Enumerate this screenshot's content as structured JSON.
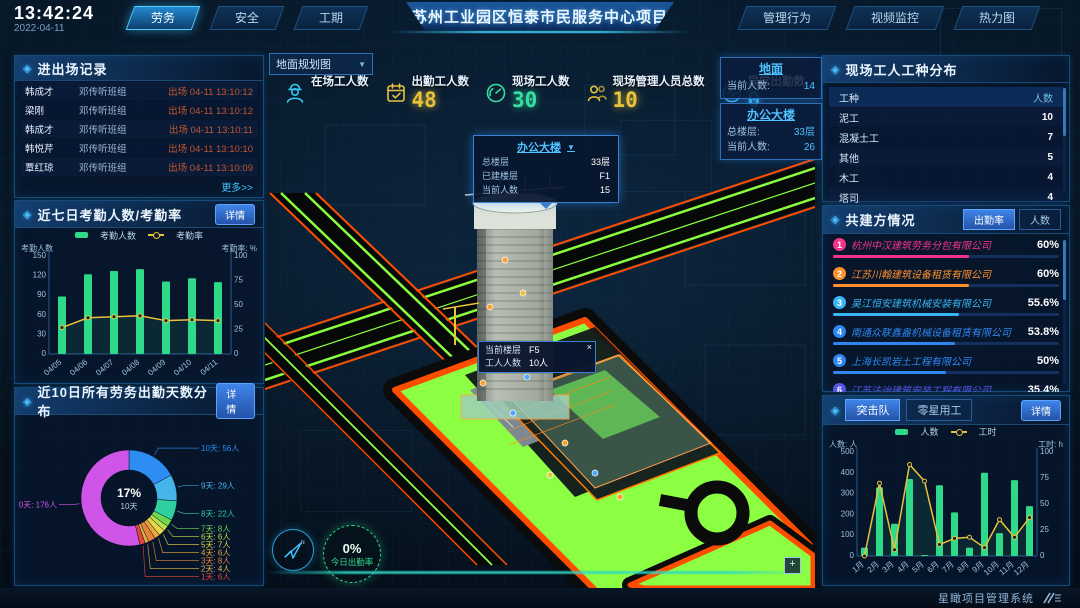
{
  "header": {
    "time": "13:42:24",
    "date": "2022-04-11",
    "tabs_left": [
      {
        "label": "劳务",
        "active": true
      },
      {
        "label": "安全",
        "active": false
      },
      {
        "label": "工期",
        "active": false
      }
    ],
    "title": "苏州工业园区恒泰市民服务中心项目",
    "tabs_right": [
      {
        "label": "管理行为"
      },
      {
        "label": "视频监控"
      },
      {
        "label": "热力图"
      }
    ]
  },
  "entry_exit": {
    "title": "进出场记录",
    "more": "更多>>",
    "rows": [
      {
        "name": "韩成才",
        "team": "邓传听班组",
        "event": "出场 04-11 13:10:12"
      },
      {
        "name": "梁刚",
        "team": "邓传听班组",
        "event": "出场 04-11 13:10:12"
      },
      {
        "name": "韩成才",
        "team": "邓传听班组",
        "event": "出场 04-11 13:10:11"
      },
      {
        "name": "韩悦芹",
        "team": "邓传听班组",
        "event": "出场 04-11 13:10:10"
      },
      {
        "name": "覃红琼",
        "team": "邓传听班组",
        "event": "出场 04-11 13:10:09"
      }
    ]
  },
  "panels": {
    "attendance7": {
      "title": "近七日考勤人数/考勤率",
      "detail": "详情"
    },
    "days10": {
      "title": "近10日所有劳务出勤天数分布",
      "detail": "详情"
    },
    "trades": {
      "title": "现场工人工种分布",
      "headers": [
        "工种",
        "人数"
      ],
      "rows": [
        [
          "泥工",
          "10"
        ],
        [
          "混凝土工",
          "7"
        ],
        [
          "其他",
          "5"
        ],
        [
          "木工",
          "4"
        ],
        [
          "塔司",
          "4"
        ]
      ]
    },
    "partners": {
      "title": "共建方情况",
      "tabs": [
        {
          "label": "出勤率",
          "active": true
        },
        {
          "label": "人数",
          "active": false
        }
      ],
      "items": [
        {
          "rank": "1",
          "name": "杭州中汉建筑劳务分包有限公司",
          "value": "60%",
          "pct": 60,
          "color": "#f5338c"
        },
        {
          "rank": "2",
          "name": "江苏川翰建筑设备租赁有限公司",
          "value": "60%",
          "pct": 60,
          "color": "#ff8f2b"
        },
        {
          "rank": "3",
          "name": "吴江恒安建筑机械安装有限公司",
          "value": "55.6%",
          "pct": 55.6,
          "color": "#3ab4f2"
        },
        {
          "rank": "4",
          "name": "南通众联鑫盎机械设备租赁有限公司",
          "value": "53.8%",
          "pct": 53.8,
          "color": "#2f86f0"
        },
        {
          "rank": "5",
          "name": "上海长凯岩土工程有限公司",
          "value": "50%",
          "pct": 50,
          "color": "#2f86f0"
        },
        {
          "rank": "6",
          "name": "江苏法诒建筑安装工程有限公司",
          "value": "35.4%",
          "pct": 35.4,
          "color": "#5a55e8"
        }
      ]
    },
    "assault": {
      "tabs": [
        {
          "label": "突击队",
          "active": true
        },
        {
          "label": "零星用工",
          "active": false
        }
      ],
      "detail": "详情"
    }
  },
  "stats": [
    {
      "icon": "worker-icon",
      "label": "在场工人数",
      "value": ""
    },
    {
      "icon": "calendar-check-icon",
      "label": "出勤工人数",
      "value": "48"
    },
    {
      "icon": "gauge-icon",
      "label": "现场工人数",
      "value": "30"
    },
    {
      "icon": "people-icon",
      "label": "现场管理人员总数",
      "value": "10"
    },
    {
      "icon": "pulse-icon",
      "label": "异常出勤数",
      "value": "0"
    }
  ],
  "viewport": {
    "map_select": "地面规划图",
    "cards": [
      {
        "title": "地面",
        "rows": [
          {
            "label": "当前人数:",
            "value": "14"
          }
        ]
      },
      {
        "title": "办公大楼",
        "rows": [
          {
            "label": "总楼层:",
            "value": "33层"
          },
          {
            "label": "当前人数:",
            "value": "26"
          }
        ]
      }
    ],
    "building_tooltip": {
      "title": "办公大楼",
      "rows": [
        {
          "label": "总楼层",
          "value": "33层"
        },
        {
          "label": "已建楼层",
          "value": "F1"
        },
        {
          "label": "当前人数",
          "value": "15"
        }
      ]
    },
    "floor_tooltip": {
      "rows": [
        {
          "label": "当前楼层",
          "value": "F5"
        },
        {
          "label": "工人人数",
          "value": "10人"
        }
      ],
      "close": "×"
    },
    "attendance_badge": {
      "value": "0%",
      "label": "今日出勤率"
    }
  },
  "footer": {
    "brand": "星瞰项目管理系统"
  },
  "chart_data": [
    {
      "id": "attendance7",
      "type": "bar+line",
      "title": "近七日考勤人数/考勤率",
      "categories": [
        "04/05",
        "04/06",
        "04/07",
        "04/08",
        "04/09",
        "04/10",
        "04/11"
      ],
      "series": [
        {
          "name": "考勤人数",
          "type": "bar",
          "color": "#2fd98a",
          "axis": "left",
          "values": [
            88,
            122,
            127,
            130,
            111,
            116,
            110
          ]
        },
        {
          "name": "考勤率",
          "type": "line",
          "color": "#e8c23a",
          "axis": "right",
          "values": [
            27,
            37,
            38,
            39,
            34,
            35,
            34
          ]
        }
      ],
      "left_axis": {
        "label": "考勤人数",
        "min": 0,
        "max": 150,
        "ticks": [
          0,
          30,
          60,
          90,
          120,
          150
        ]
      },
      "right_axis": {
        "label": "考勤率: %",
        "min": 0,
        "max": 100,
        "ticks": [
          0,
          25,
          50,
          75,
          100
        ]
      }
    },
    {
      "id": "days10",
      "type": "donut",
      "title": "近10日所有劳务出勤天数分布",
      "center": {
        "pct": "17%",
        "label": "10天"
      },
      "slices": [
        {
          "name": "10天",
          "value": 56,
          "unit": "人",
          "color": "#2e8df2"
        },
        {
          "name": "9天",
          "value": 29,
          "unit": "人",
          "color": "#45b4e8"
        },
        {
          "name": "8天",
          "value": 22,
          "unit": "人",
          "color": "#2fd0a0"
        },
        {
          "name": "7天",
          "value": 8,
          "unit": "人",
          "color": "#6fd84e"
        },
        {
          "name": "6天",
          "value": 6,
          "unit": "人",
          "color": "#b8e04a"
        },
        {
          "name": "5天",
          "value": 7,
          "unit": "人",
          "color": "#e8d44a"
        },
        {
          "name": "4天",
          "value": 6,
          "unit": "人",
          "color": "#e8a83a"
        },
        {
          "name": "3天",
          "value": 8,
          "unit": "人",
          "color": "#e8813a"
        },
        {
          "name": "2天",
          "value": 4,
          "unit": "人",
          "color": "#d8b84a"
        },
        {
          "name": "1天",
          "value": 6,
          "unit": "人",
          "color": "#e8433a"
        },
        {
          "name": "0天",
          "value": 176,
          "unit": "人",
          "color": "#cf55e8"
        }
      ]
    },
    {
      "id": "assault",
      "type": "bar+line",
      "title": "突击队",
      "categories": [
        "1月",
        "2月",
        "3月",
        "4月",
        "5月",
        "6月",
        "7月",
        "8月",
        "9月",
        "10月",
        "11月",
        "12月"
      ],
      "series": [
        {
          "name": "人数",
          "type": "bar",
          "color": "#2fd98a",
          "axis": "left",
          "values": [
            40,
            330,
            155,
            370,
            5,
            340,
            210,
            40,
            400,
            110,
            365,
            240
          ]
        },
        {
          "name": "工时",
          "type": "line",
          "color": "#e8c23a",
          "axis": "right",
          "values": [
            0,
            70,
            6,
            88,
            72,
            11,
            17,
            18,
            8,
            35,
            18,
            37
          ]
        }
      ],
      "left_axis": {
        "label": "人数: 人",
        "min": 0,
        "max": 500,
        "ticks": [
          0,
          100,
          200,
          300,
          400,
          500
        ]
      },
      "right_axis": {
        "label": "工时: h",
        "min": 0,
        "max": 100,
        "ticks": [
          0,
          25,
          50,
          75,
          100
        ]
      }
    }
  ]
}
